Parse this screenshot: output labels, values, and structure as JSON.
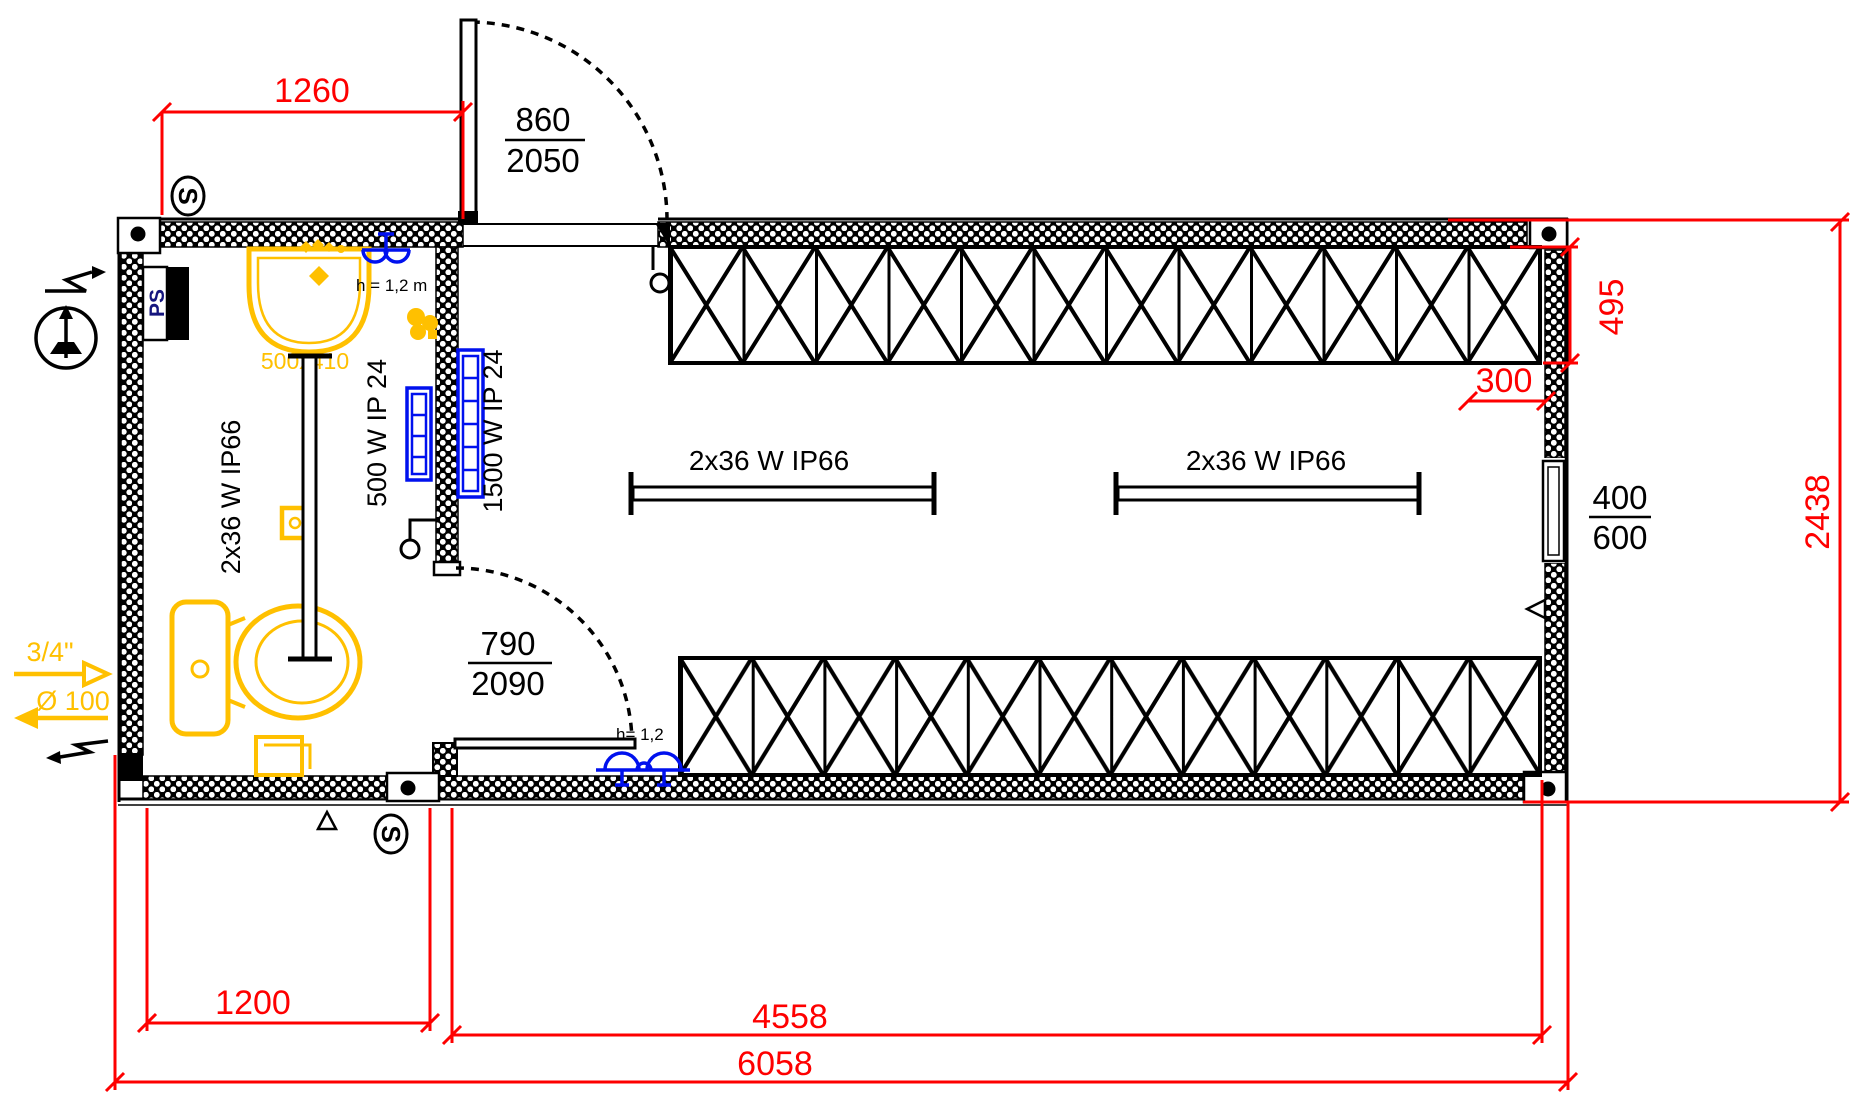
{
  "drawing": {
    "title": "container-cabin-floor-plan",
    "dims": {
      "w1260": "1260",
      "w1200": "1200",
      "w4558": "4558",
      "w6058": "6058",
      "h2438": "2438",
      "rack_depth": "495",
      "offset300": "300"
    },
    "doors": {
      "top": {
        "w": "860",
        "h": "2050"
      },
      "internal": {
        "w": "790",
        "h": "2090"
      }
    },
    "window": {
      "w": "400",
      "h": "600"
    },
    "equipment": {
      "light_bath": "2x36 W IP66",
      "light_main_left": "2x36 W IP66",
      "light_main_right": "2x36 W IP66",
      "heater_500": "500 W IP 24",
      "heater_1500": "1500 W IP 24",
      "sink_size": "500x410",
      "panel": "PS",
      "switch": "S"
    },
    "annotations": {
      "socket_top": "h = 1,2 m",
      "socket_bottom": "h= 1,2",
      "water_supply": "3/4\"",
      "drain": "Ø 100"
    },
    "colors": {
      "dimension_red": "#fe0000",
      "plumbing_yellow": "#ffc000",
      "electrical_blue": "#0011ee",
      "line_black": "#000000"
    }
  }
}
